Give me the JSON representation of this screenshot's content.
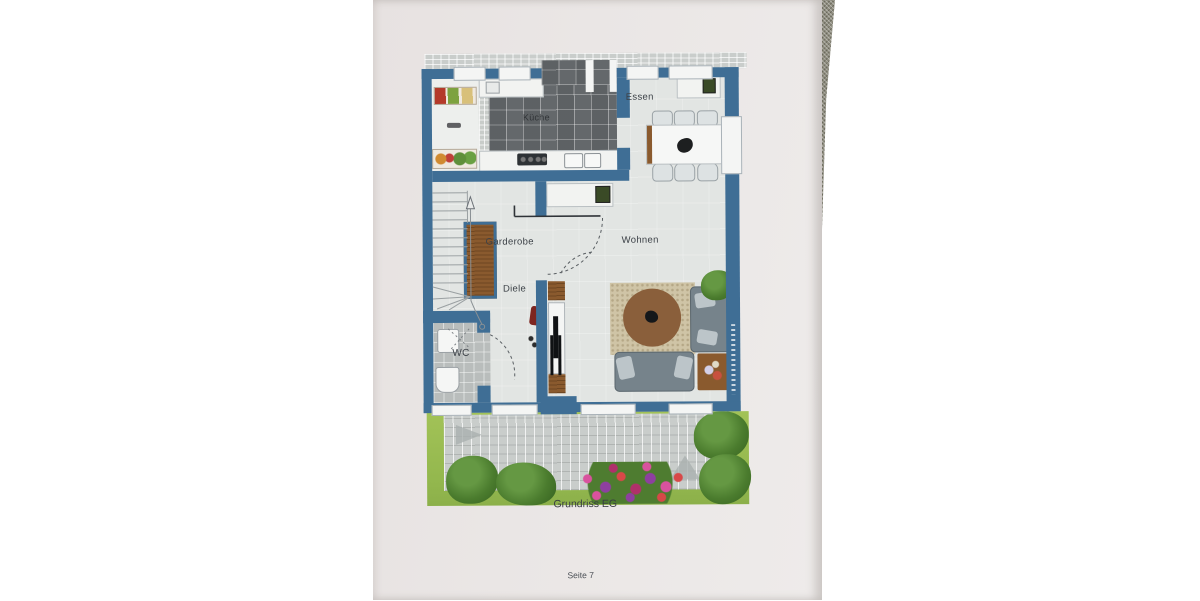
{
  "photo": {
    "caption": "Grundriss EG",
    "page_number": "Seite 7"
  },
  "floorplan": {
    "rooms": {
      "essen": "Essen",
      "kueche": "Küche",
      "garderobe": "Garderobe",
      "diele": "Diele",
      "wohnen": "Wohnen",
      "wc": "WC"
    }
  },
  "colors": {
    "wall": "#3f6e95",
    "floor": "#e2e5e3",
    "tile": "#64686b",
    "paper": "#eae6e5",
    "grass": "#a2c257",
    "terrace": "#c9cdcb",
    "rug": "#cfc4a6",
    "rug_round": "#8a5f3b",
    "sofa": "#76838b",
    "wood": "#8a5a2e",
    "label": "#3d4248"
  }
}
